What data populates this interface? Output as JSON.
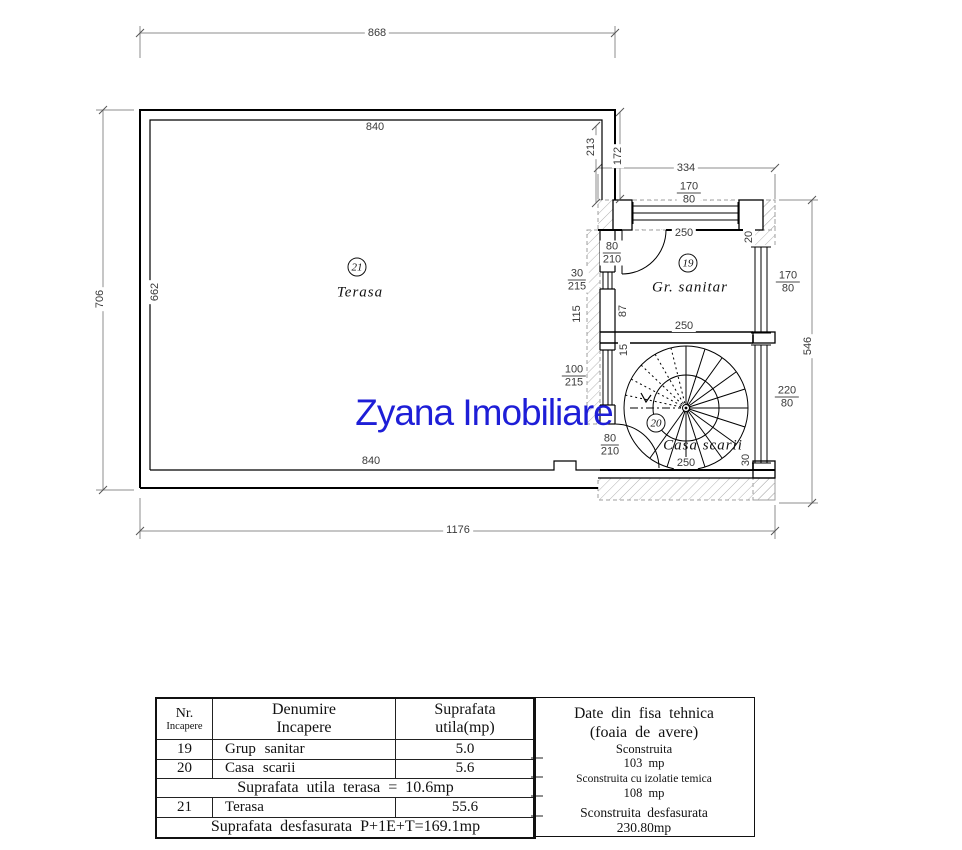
{
  "watermark": {
    "text": "Zyana Imobiliare",
    "color": "#1e1ed7"
  },
  "rooms": {
    "terasa": {
      "num": "21",
      "name": "Terasa"
    },
    "gr_sanitar": {
      "num": "19",
      "name": "Gr. sanitar"
    },
    "casa_scarii": {
      "num": "20",
      "name": "Casa scarii"
    }
  },
  "dims": {
    "overall_width": "868",
    "terasa_inner_width_top": "840",
    "terasa_inner_width_bottom": "840",
    "left_total_height": "706",
    "terasa_inner_height": "662",
    "bottom_total_width": "1176",
    "annex_width": "334",
    "annex_right_height": "546",
    "notch_height_outer": "213",
    "notch_height_inner": "172",
    "pier_20": "20",
    "wall_115": "115",
    "wall_87": "87",
    "pier_15": "15",
    "pier_30": "30",
    "win_top_width": "250",
    "sanitar_width": "250",
    "scara_width": "250"
  },
  "openings": {
    "win_annex_top": {
      "w": "170",
      "h": "80"
    },
    "win_right_sanitar": {
      "w": "170",
      "h": "80"
    },
    "win_right_scara": {
      "w": "220",
      "h": "80"
    },
    "door_sanitar": {
      "w": "80",
      "h": "210"
    },
    "door_scara": {
      "w": "80",
      "h": "210"
    },
    "win_left_small": {
      "w": "30",
      "h": "215"
    },
    "win_left_large": {
      "w": "100",
      "h": "215"
    }
  },
  "legend_table": {
    "header": {
      "col1_line1": "Nr.",
      "col1_line2": "Incapere",
      "col2_line1": "Denumire",
      "col2_line2": "Incapere",
      "col3_line1": "Suprafata",
      "col3_line2": "utila(mp)"
    },
    "rows": [
      {
        "nr": "19",
        "name": "Grup sanitar",
        "area": "5.0"
      },
      {
        "nr": "20",
        "name": "Casa scarii",
        "area": "5.6"
      }
    ],
    "terasa_subtotal": "Suprafata utila terasa = 10.6mp",
    "terasa_row": {
      "nr": "21",
      "name": "Terasa",
      "area": "55.6"
    },
    "total": "Suprafata desfasurata P+1E+T=169.1mp"
  },
  "tech_panel": {
    "title_line1": "Date din fisa tehnica",
    "title_line2": "(foaia de avere)",
    "item1_label": "Sconstruita",
    "item1_value": "103 mp",
    "item2_label": "Sconstruita cu izolatie temica",
    "item2_value": "108 mp",
    "item3_label": "Sconstruita desfasurata",
    "item3_value": "230.80mp"
  }
}
